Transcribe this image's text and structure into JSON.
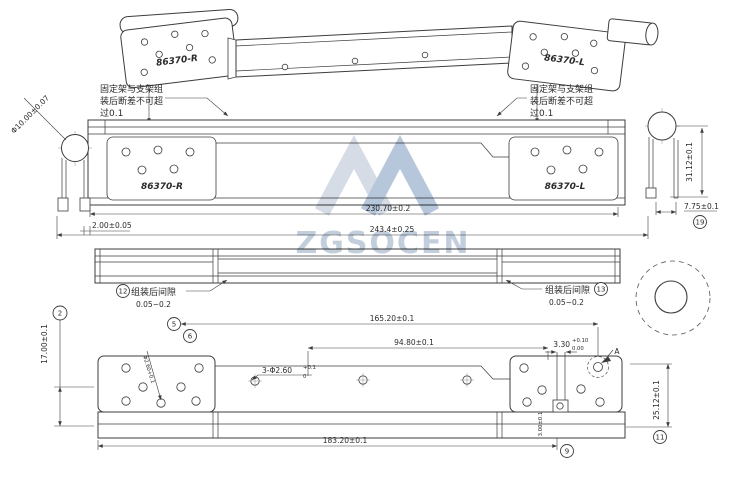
{
  "watermark": {
    "text": "ZGSOCEN",
    "color": "#aebdd0"
  },
  "parts": {
    "top_right_label": "86370-R",
    "top_left_label": "86370-L",
    "front_right_label": "86370-R",
    "front_left_label": "86370-L"
  },
  "notes": {
    "fix_note_left": {
      "line1": "固定架与支架组",
      "line2": "装后断差不可超",
      "line3": "过0.1"
    },
    "fix_note_right": {
      "line1": "固定架与支架组",
      "line2": "装后断差不可超",
      "line3": "过0.1"
    },
    "gap_note_left": {
      "label": "组装后间隙",
      "value": "0.05~0.2"
    },
    "gap_note_right": {
      "label": "组装后间隙",
      "value": "0.05~0.2"
    }
  },
  "dims": {
    "tube_dia": "Φ10.00±0.07",
    "width_inner": "230.70±0.2",
    "width_overall": "243.4±0.25",
    "edge_gap": "2.00±0.05",
    "side_height": "31.12±0.1",
    "side_offset": "7.75±0.1",
    "bottom_height": "17.00±0.1",
    "span_outer": "165.20±0.1",
    "span_inner": "94.80±0.1",
    "holes_callout": "3-Φ2.60",
    "holes_tol_up": "+0.1",
    "holes_tol_dn": "0",
    "plate_hole_callout": "Φ2.60+0.1",
    "slot_width": "3.30",
    "slot_tol_up": "+0.10",
    "slot_tol_dn": "0.00",
    "right_height": "25.12±0.1",
    "bottom_span": "183.20±0.1",
    "tab_height": "3.00±0.1",
    "datum": "A"
  },
  "balloons": {
    "b2": "2",
    "b5": "5",
    "b6": "6",
    "b9": "9",
    "b11": "11",
    "b12": "12",
    "b13": "13",
    "b19": "19"
  }
}
